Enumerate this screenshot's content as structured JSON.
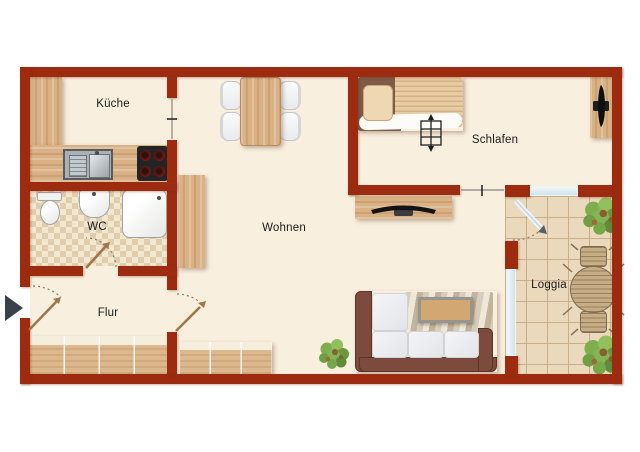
{
  "plan": {
    "rooms": {
      "kueche": {
        "label": "Küche"
      },
      "schlafen": {
        "label": "Schlafen"
      },
      "wohnen": {
        "label": "Wohnen"
      },
      "wc": {
        "label": "WC"
      },
      "flur": {
        "label": "Flur"
      },
      "loggia": {
        "label": "Loggia"
      }
    },
    "colors": {
      "wall": "#9d2b10",
      "floor": "#f9efde",
      "wood": "#d9b384",
      "tiles": "#ead9bd",
      "window_glass": "#cfe3ec",
      "door_leaf": "#a1764b",
      "entry_arrow": "#3b4148",
      "label_text": "#1b1b1b"
    },
    "symbols": {
      "entry_arrow": "entry-direction-arrow",
      "door_swing": "door-swing-arc",
      "open_doorway": "open-doorway-tick"
    }
  }
}
